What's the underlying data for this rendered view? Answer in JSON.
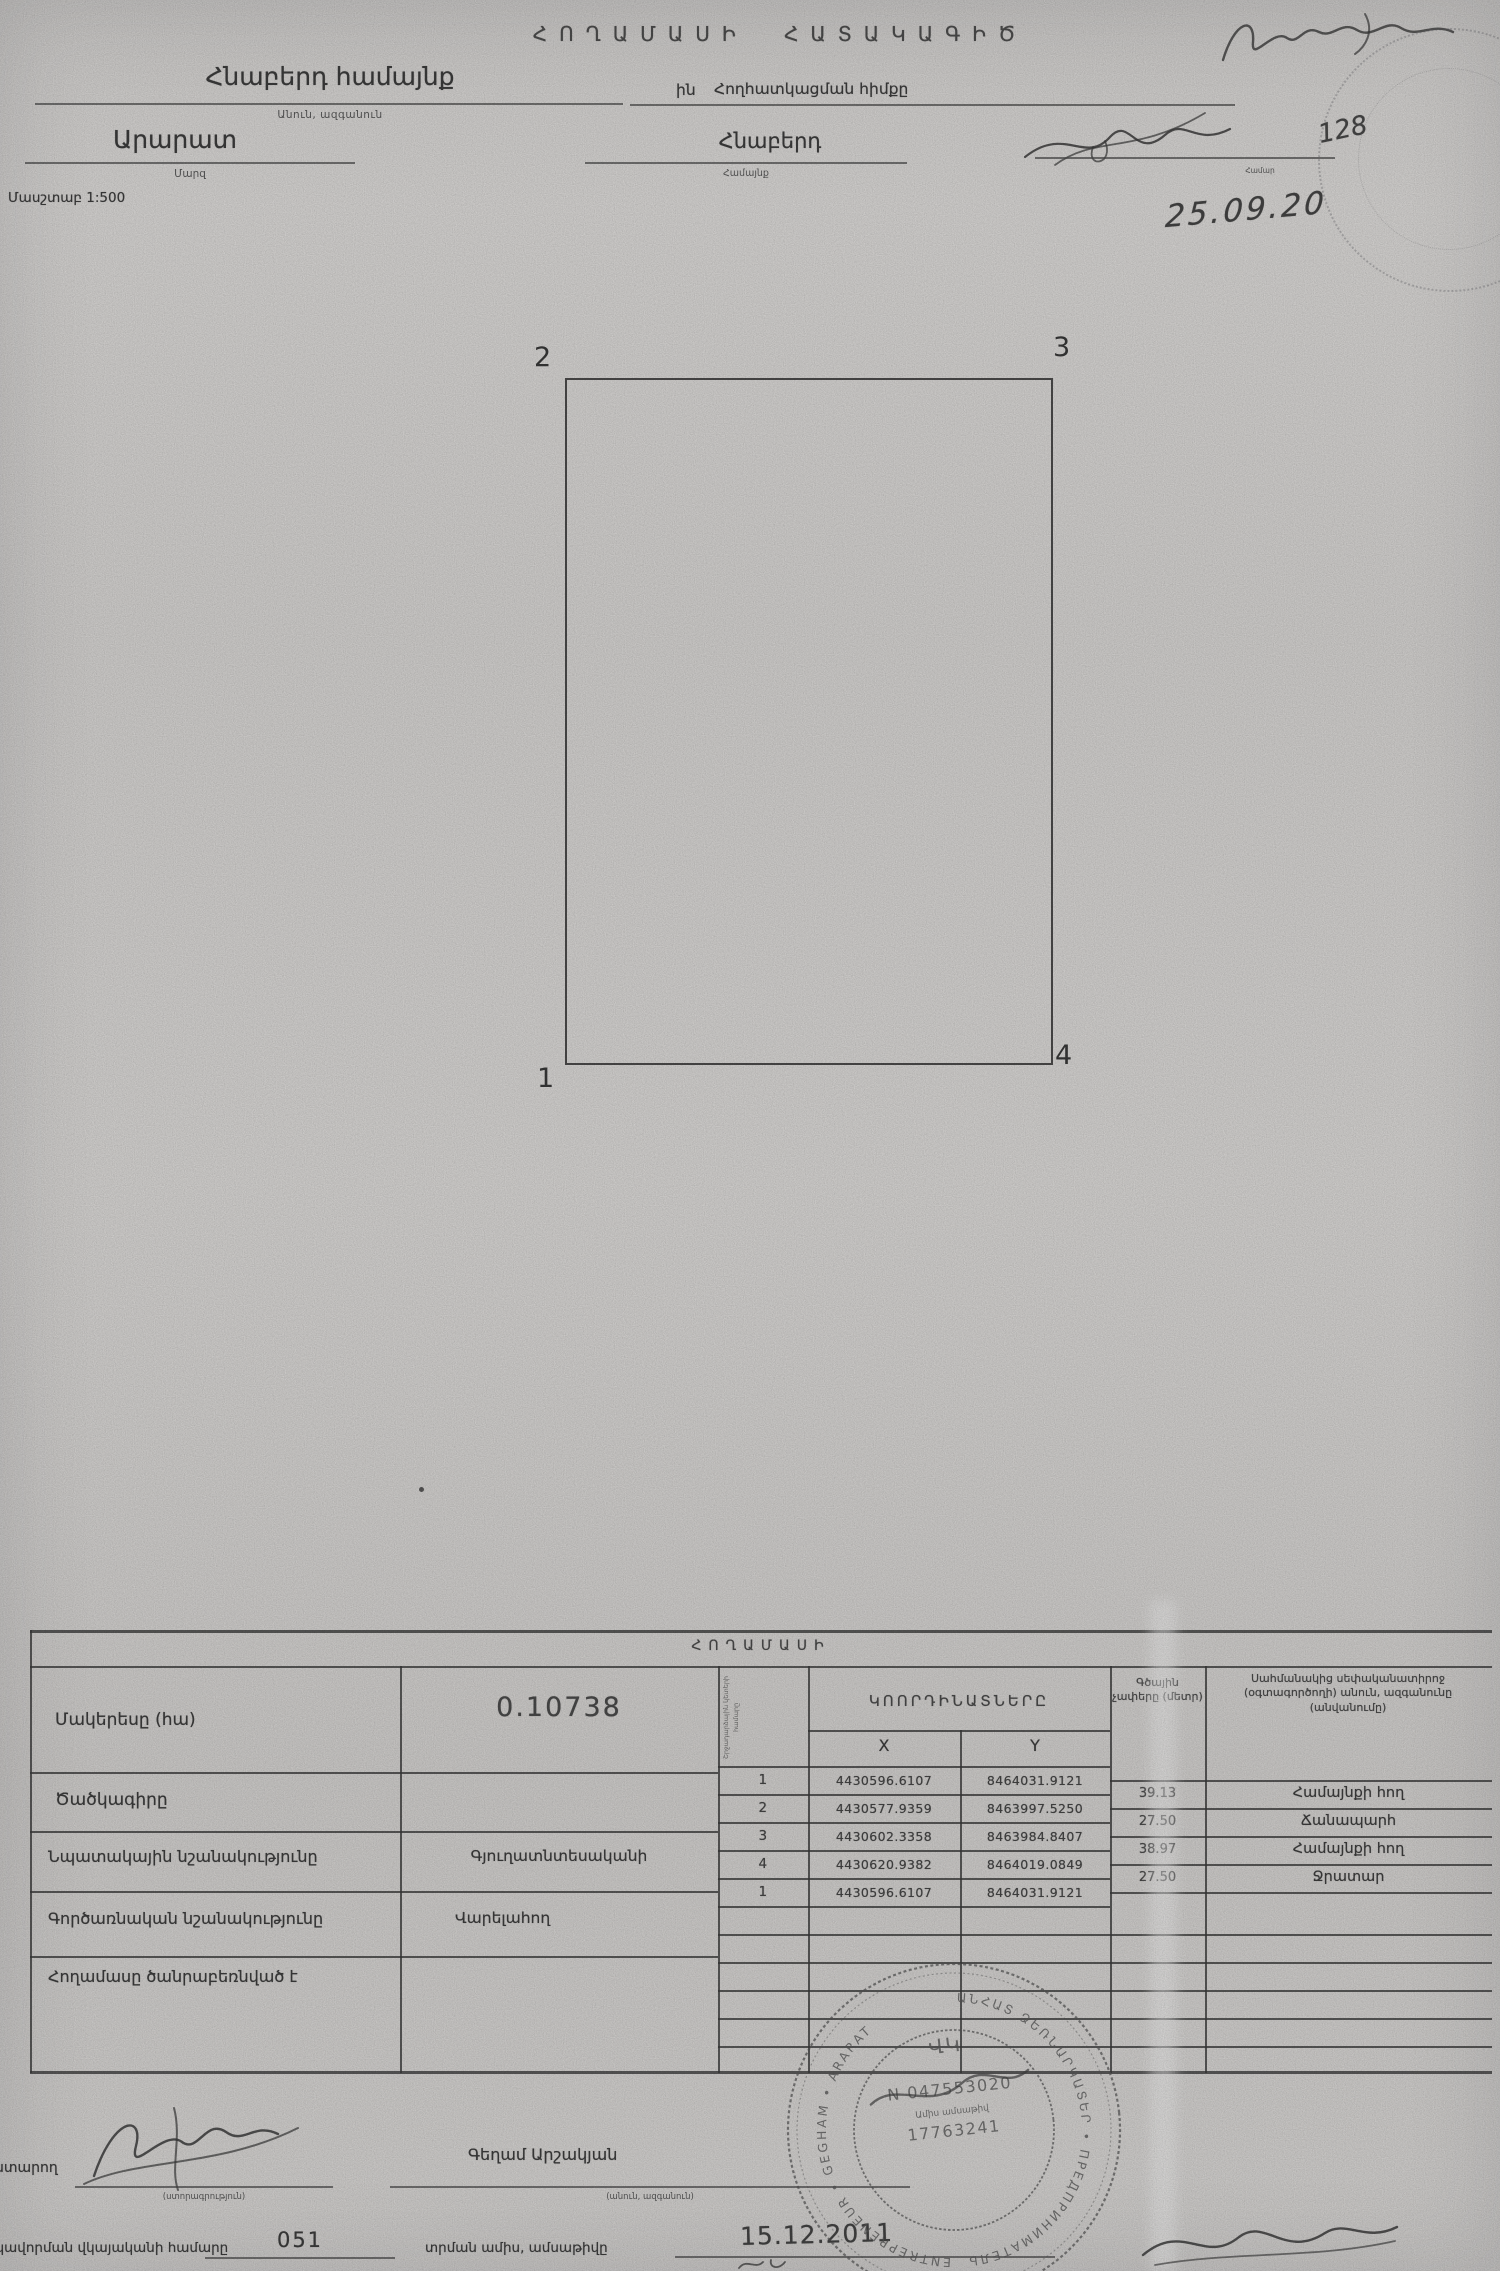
{
  "header": {
    "title": "ՀՈՂԱՄԱՍԻ ՀԱՏԱԿԱԳԻԾ",
    "community_name": "Հնաբերդ համայնք",
    "name_caption": "Անուն, ազգանուն",
    "alloc_prefix": "ին",
    "alloc_label": "Հողհատկացման հիմքը",
    "region_name": "Արարատ",
    "region_caption": "Մարզ",
    "settlement_name": "Հնաբերդ",
    "settlement_caption": "Համայնք",
    "scale_label": "Մասշտաբ 1:500",
    "right_caption": "Համար",
    "hand_number": "128",
    "hand_date": "25.09.20"
  },
  "plot": {
    "corner_top_left": "2",
    "corner_top_right": "3",
    "corner_bottom_left": "1",
    "corner_bottom_right": "4"
  },
  "table": {
    "strip_title": "ՀՈՂԱՄԱՍԻ",
    "area_label": "Մակերեսը (հա)",
    "area_value": "0.10738",
    "code_label": "Ծածկագիրը",
    "purpose_label": "Նպատակային նշանակությունը",
    "purpose_value": "Գյուղատնտեսականի",
    "function_label": "Գործառնական նշանակությունը",
    "function_value": "Վարելահող",
    "encumbrance_label": "Հողամասը ծանրաբեռնված է",
    "points_header": "Շրջադարձային կետերի համարը",
    "coords_header": "ԿՈՈՐԴԻՆԱՏՆԵՐԸ",
    "x_header": "X",
    "y_header": "Y",
    "coord_rows": [
      {
        "n": "1",
        "x": "4430596.6107",
        "y": "8464031.9121"
      },
      {
        "n": "2",
        "x": "4430577.9359",
        "y": "8463997.5250"
      },
      {
        "n": "3",
        "x": "4430602.3358",
        "y": "8463984.8407"
      },
      {
        "n": "4",
        "x": "4430620.9382",
        "y": "8464019.0849"
      },
      {
        "n": "1",
        "x": "4430596.6107",
        "y": "8464031.9121"
      }
    ],
    "linear_header": "Գծային չափերը (մետր)",
    "linear_rows": [
      "39.13",
      "27.50",
      "38.97",
      "27.50"
    ],
    "neighbor_header": "Սահմանակից սեփականատիրոջ (օգտագործողի) անուն, ազգանունը (անվանումը)",
    "neighbor_rows": [
      "Համայնքի հող",
      "Ճանապարհ",
      "Համայնքի հող",
      "Ջրատար"
    ]
  },
  "footer": {
    "executor_label": "Կատարող",
    "signature_caption": "(ստորագրություն)",
    "name_value": "Գեղամ Արշակյան",
    "name_caption": "(անուն, ազգանուն)",
    "certificate_label": "Որակավորման վկայականի համարը",
    "certificate_value": "051",
    "issue_label": "տրման ամիս, ամսաթիվը",
    "issue_date": "15.12.2011"
  },
  "stamp": {
    "ring_top": "ԱՆՀԱՏ ՁԵՌՆԱՐԿԱՏԵՐ • ПРЕДПРИНИМАТЕЛЬ",
    "ring_bottom": "ENTREPRENEUR • GEGHAM • ARARAT",
    "center_symbol": "ՎԿ",
    "number_line": "N 047553020",
    "date_caption": "Ամիս ամսաթիվ",
    "digits_line": "17763241"
  }
}
